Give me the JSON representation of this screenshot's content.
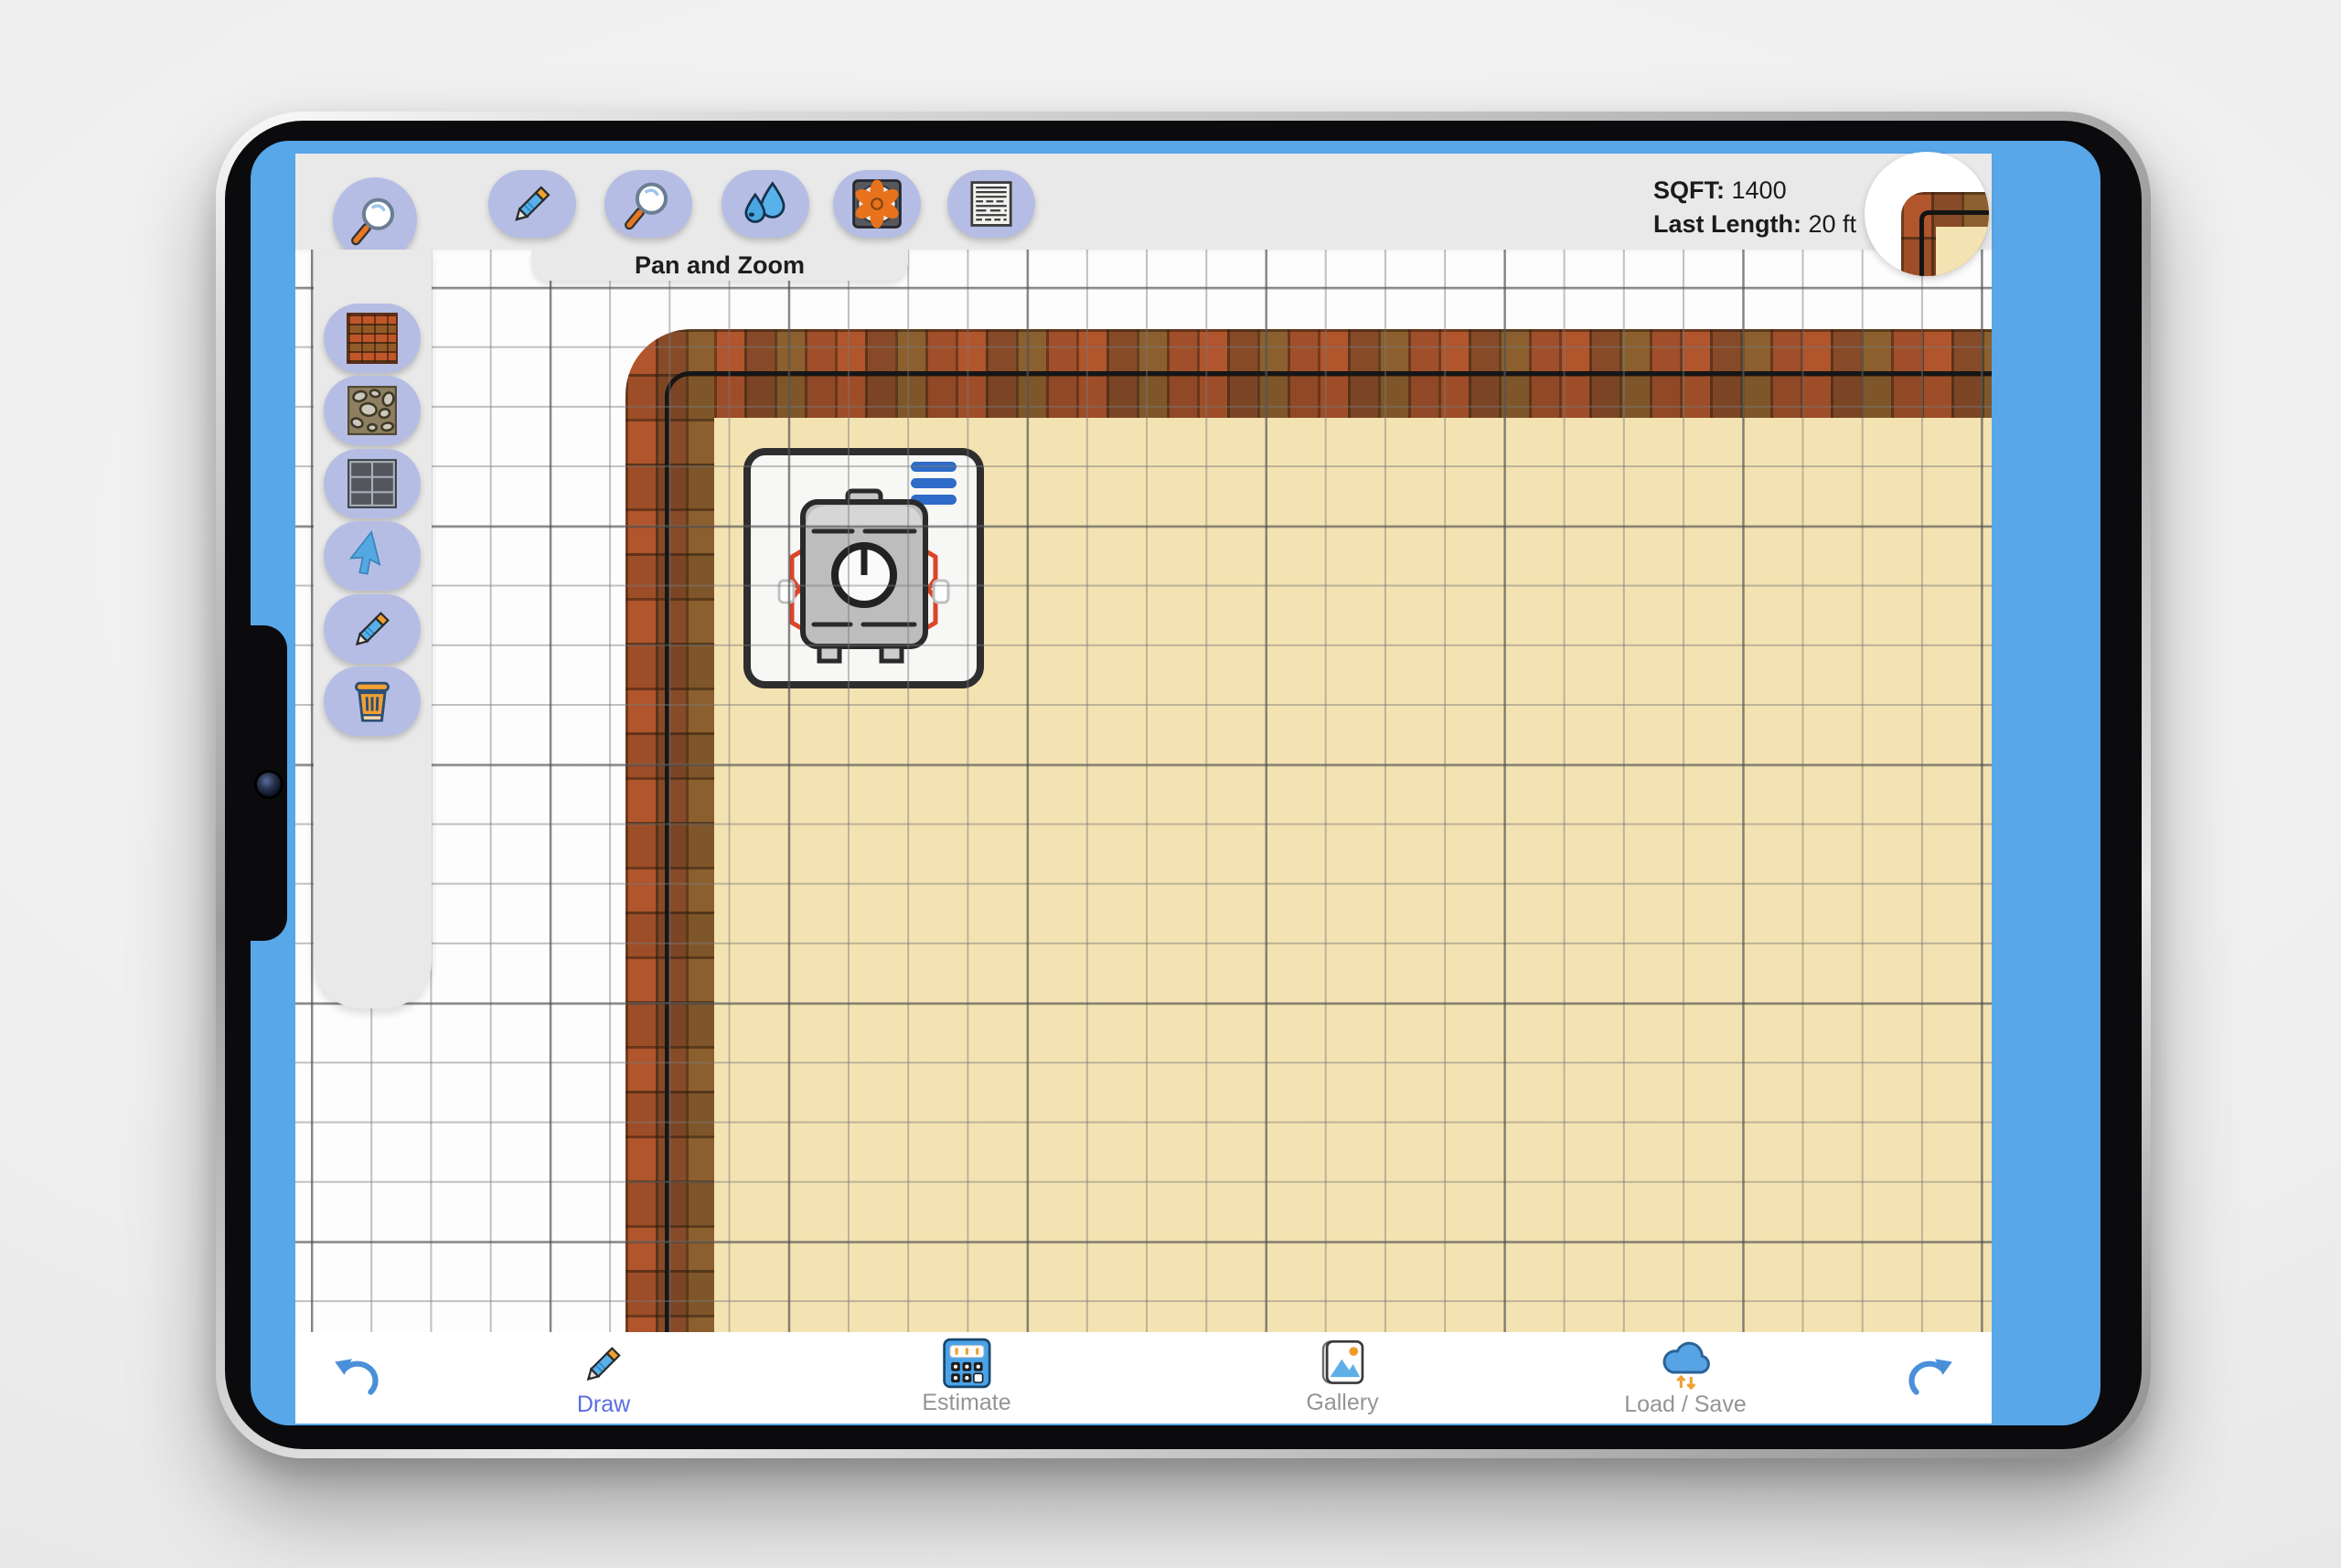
{
  "device": {
    "name": "tablet",
    "frame_color": "#0b0b0d",
    "screen_border_color": "#58a7e8"
  },
  "header": {
    "stats": {
      "sqft_label": "SQFT:",
      "sqft_value": "1400",
      "last_length_label": "Last Length:",
      "last_length_value": "20 ft"
    },
    "minimap": {
      "description": "wall-corner-thumbnail"
    }
  },
  "top_toolbar": {
    "active_tool_label": "Pan and Zoom",
    "standalone_button": {
      "id": "zoom-tool",
      "icon": "magnifier-icon"
    },
    "buttons": [
      {
        "id": "draw-wall-tool",
        "icon": "pencil-icon"
      },
      {
        "id": "pan-zoom-tool",
        "icon": "magnifier-icon",
        "active": true
      },
      {
        "id": "water-tool",
        "icon": "water-drops-icon"
      },
      {
        "id": "vent-tool",
        "icon": "fan-icon"
      },
      {
        "id": "material-tool",
        "icon": "lined-panel-icon"
      }
    ]
  },
  "sidebar": {
    "tools": [
      {
        "id": "brick-material",
        "icon": "brick-icon"
      },
      {
        "id": "stone-material",
        "icon": "stone-icon"
      },
      {
        "id": "paver-material",
        "icon": "paver-grid-icon"
      },
      {
        "id": "select-tool",
        "icon": "cursor-icon"
      },
      {
        "id": "pencil-tool",
        "icon": "pencil-icon"
      },
      {
        "id": "delete-tool",
        "icon": "trash-icon"
      }
    ]
  },
  "canvas": {
    "sqft": "1400",
    "last_length": "20 ft",
    "walls": "L-shaped brick wall along top and left",
    "floor_color": "#f4e3b2",
    "objects": [
      {
        "id": "water-heater",
        "icon": "water-heater-icon",
        "menu_icon": "menu-bars-icon"
      }
    ]
  },
  "bottom_toolbar": {
    "items": [
      {
        "id": "undo",
        "icon": "undo-arrow-icon"
      },
      {
        "id": "draw",
        "icon": "pencil-icon",
        "label": "Draw",
        "active": true
      },
      {
        "id": "estimate",
        "icon": "calculator-icon",
        "label": "Estimate"
      },
      {
        "id": "gallery",
        "icon": "gallery-icon",
        "label": "Gallery"
      },
      {
        "id": "load_save",
        "icon": "cloud-icon",
        "label": "Load / Save"
      },
      {
        "id": "redo",
        "icon": "redo-arrow-icon"
      }
    ]
  },
  "colors": {
    "screen_frame_blue": "#58a7e8",
    "panel_gray": "#e9e9e9",
    "button_lavender": "#b6bde5",
    "floor_tan": "#f4e3b2",
    "brick_brown": "#9a5030",
    "wall_line_black": "#161616",
    "active_label_blue": "#5a6ce0",
    "inactive_label_gray": "#949494",
    "accent_orange": "#f09a28",
    "accent_blue": "#4a90d9"
  }
}
